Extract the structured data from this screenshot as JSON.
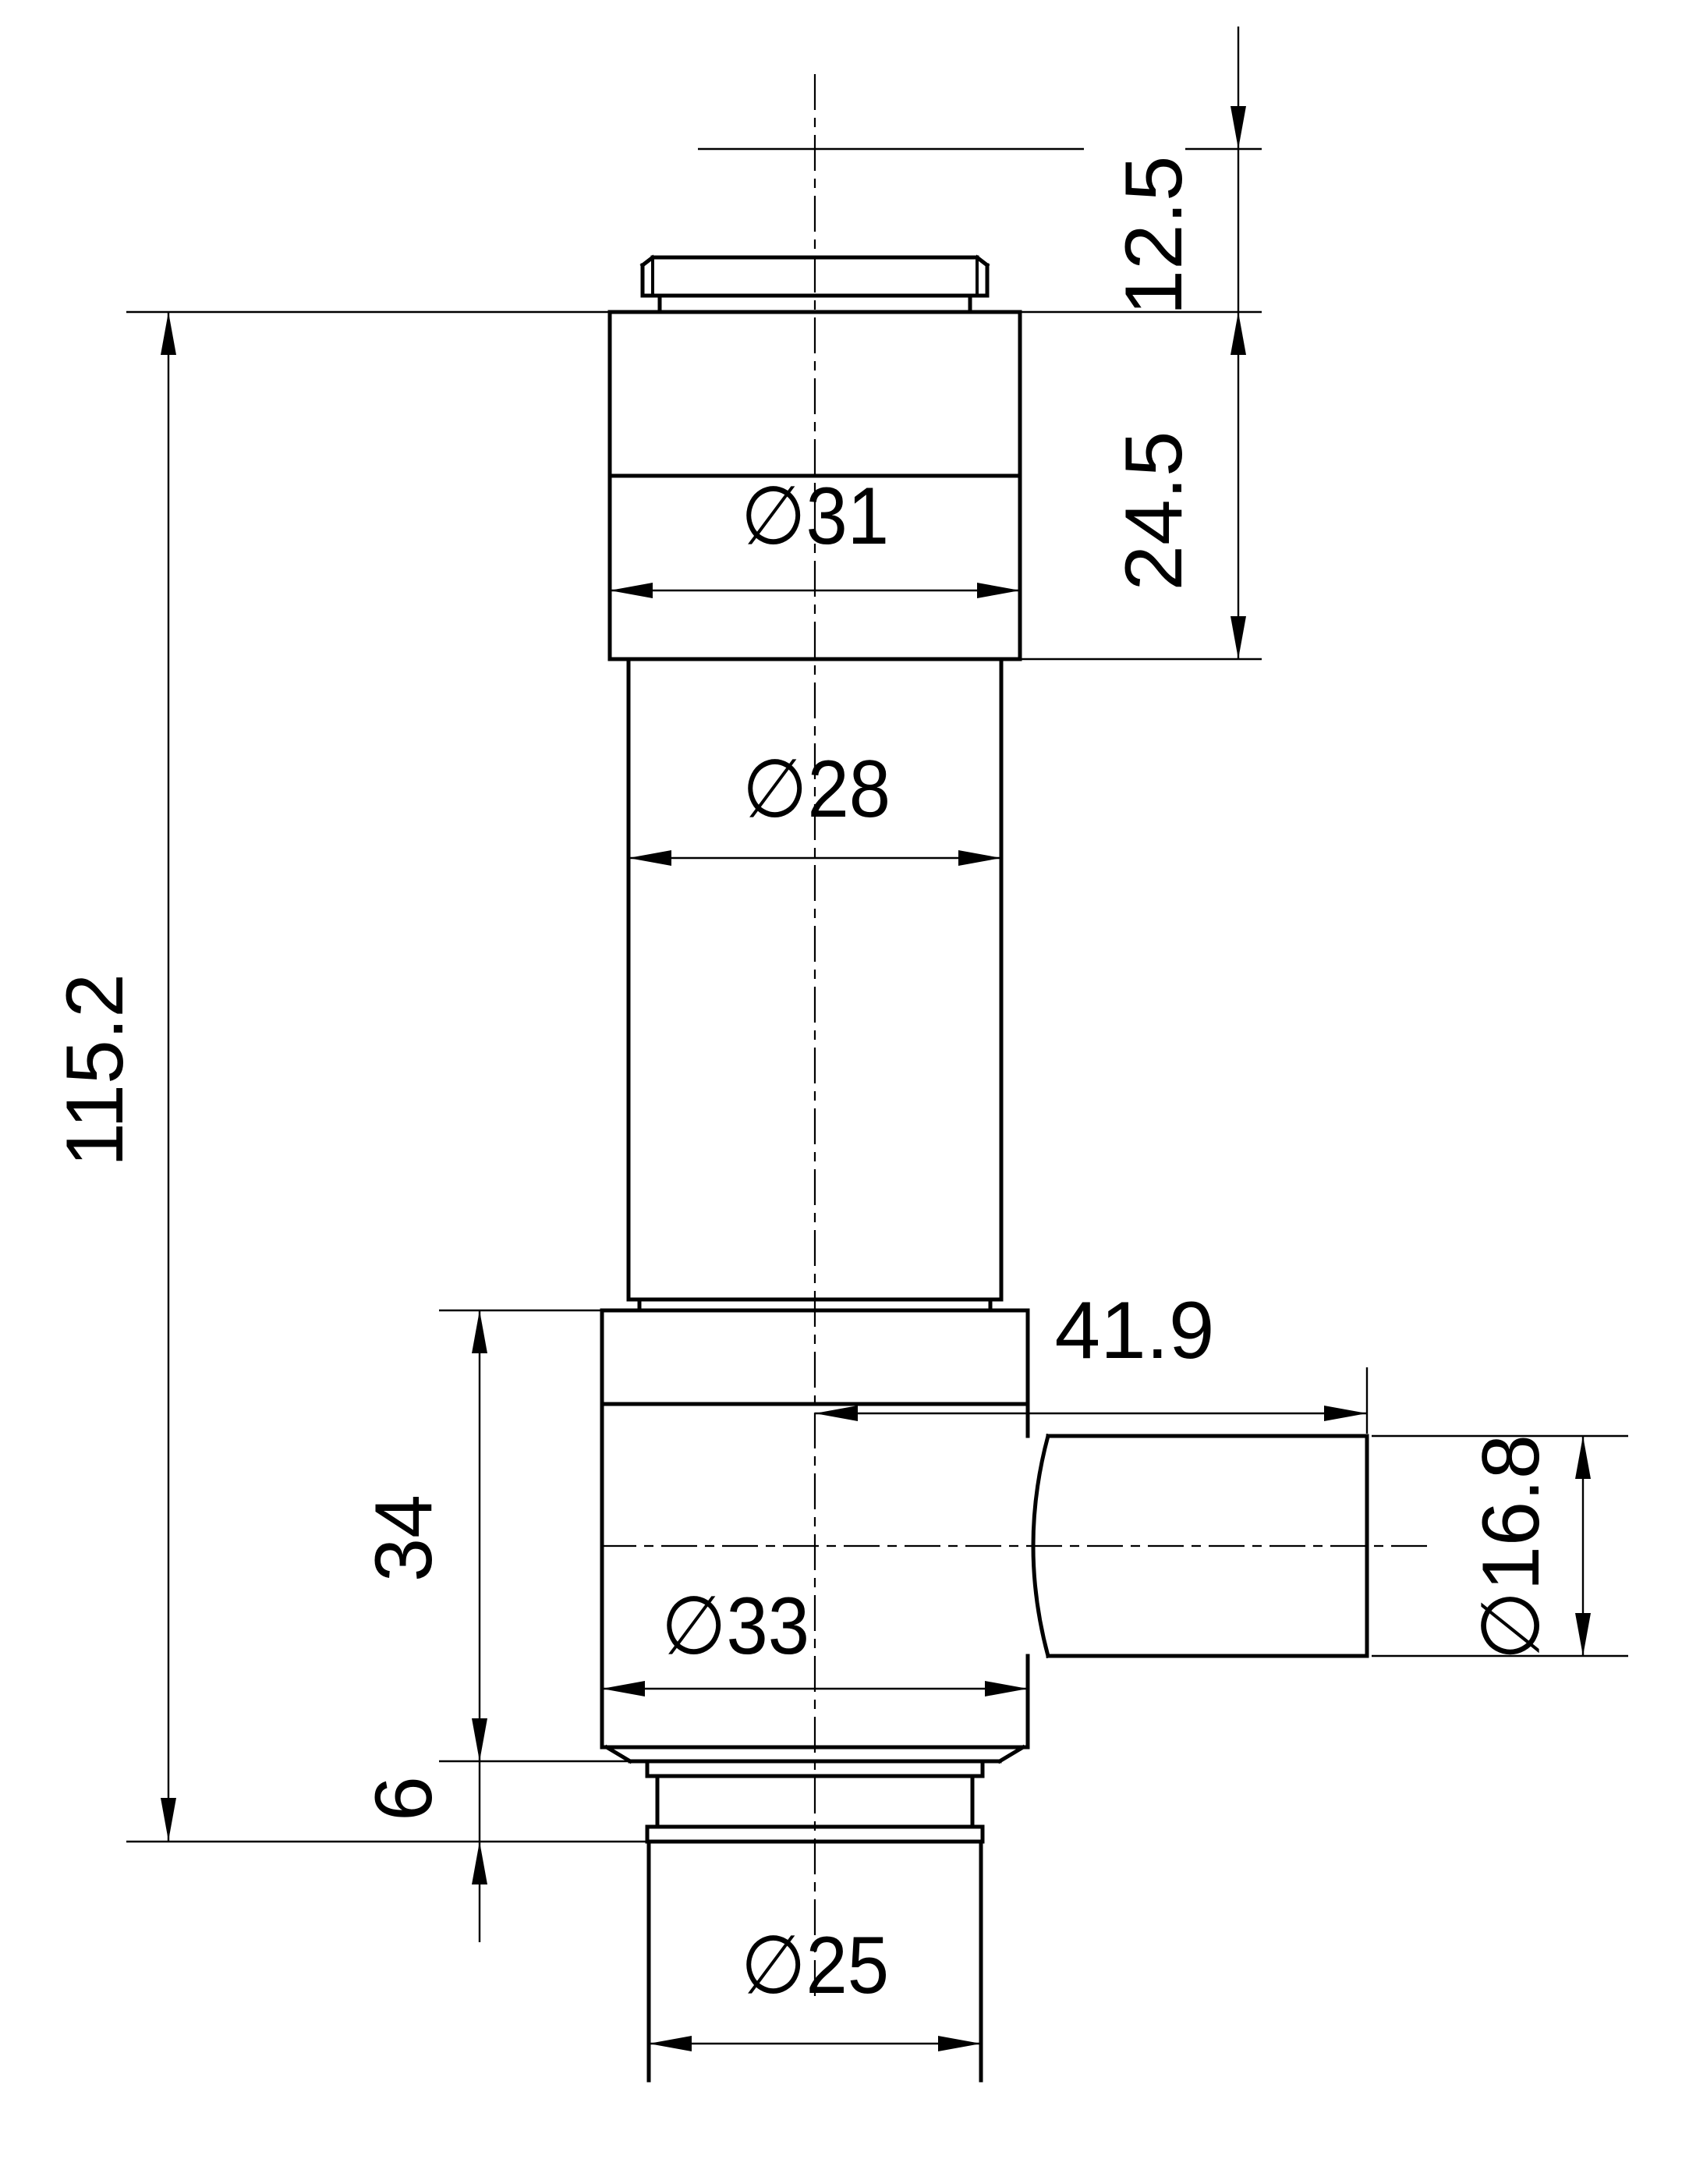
{
  "drawing": {
    "kind": "technical-drawing",
    "view": "side elevation with dimensions",
    "units": "mm",
    "background_color": "#ffffff",
    "line_color": "#000000",
    "diameter_symbol": "∅",
    "dimensions": {
      "cap_travel": {
        "label": "12.5",
        "value": 12.5,
        "axis": "vertical"
      },
      "upper_height": {
        "label": "24.5",
        "value": 24.5,
        "axis": "vertical"
      },
      "upper_dia": {
        "label": "∅31",
        "value": 31,
        "axis": "horizontal"
      },
      "stem_dia": {
        "label": "∅28",
        "value": 28,
        "axis": "horizontal"
      },
      "total_height": {
        "label": "115.2",
        "value": 115.2,
        "axis": "vertical"
      },
      "port_length": {
        "label": "41.9",
        "value": 41.9,
        "axis": "horizontal"
      },
      "flange_height": {
        "label": "34",
        "value": 34,
        "axis": "vertical"
      },
      "flange_dia": {
        "label": "∅33",
        "value": 33,
        "axis": "horizontal"
      },
      "port_dia": {
        "label": "∅16.8",
        "value": 16.8,
        "axis": "vertical"
      },
      "groove_height": {
        "label": "6",
        "value": 6,
        "axis": "vertical"
      },
      "outlet_dia": {
        "label": "∅25",
        "value": 25,
        "axis": "horizontal"
      }
    }
  }
}
